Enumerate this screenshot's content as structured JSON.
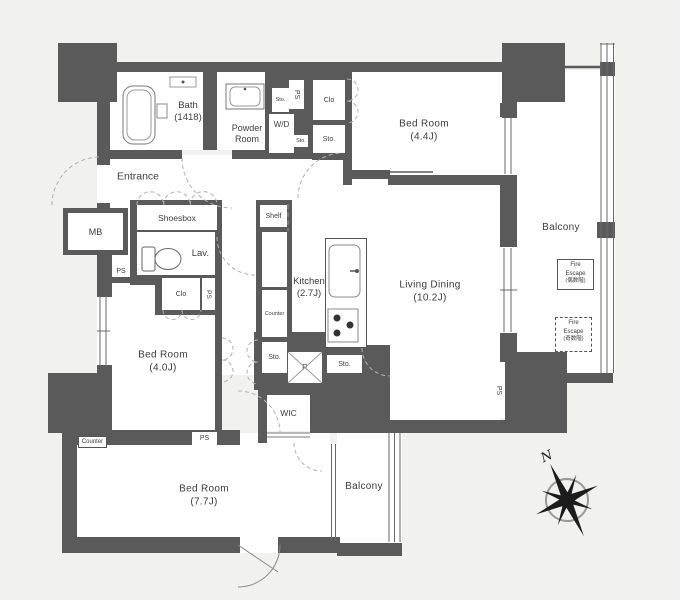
{
  "rooms": {
    "bath": {
      "name": "Bath",
      "size": "(1418)"
    },
    "powder_room": {
      "name": "Powder",
      "name2": "Room"
    },
    "entrance": {
      "name": "Entrance"
    },
    "bed_room_44": {
      "name": "Bed Room",
      "size": "(4.4J)"
    },
    "bed_room_40": {
      "name": "Bed Room",
      "size": "(4.0J)"
    },
    "bed_room_77": {
      "name": "Bed Room",
      "size": "(7.7J)"
    },
    "living_dining": {
      "name": "Living Dining",
      "size": "(10.2J)"
    },
    "kitchen": {
      "name": "Kitchen",
      "size": "(2.7J)"
    },
    "balcony_right": {
      "name": "Balcony"
    },
    "balcony_bottom": {
      "name": "Balcony"
    },
    "wic": {
      "name": "WIC"
    }
  },
  "features": {
    "shoesbox": "Shoesbox",
    "shelf": "Shelf",
    "meter_box": "MB",
    "lavatory": "Lav.",
    "washer_dryer": "W/D",
    "storage": "Sto.",
    "pipe_space": "PS",
    "closet": "Clo",
    "counter": "Counter",
    "refrigerator": "R"
  },
  "fire_escape_upper": {
    "line1": "Fire",
    "line2": "Escape",
    "line3": "(偶数階)"
  },
  "fire_escape_lower": {
    "line1": "Fire",
    "line2": "Escape",
    "line3": "(奇数階)"
  },
  "compass": {
    "north_label": "N"
  },
  "colors": {
    "wall": "#5a5a5a",
    "floor": "#ffffff",
    "background": "#f1f1f0",
    "door_arc": "#b0b0b0"
  }
}
